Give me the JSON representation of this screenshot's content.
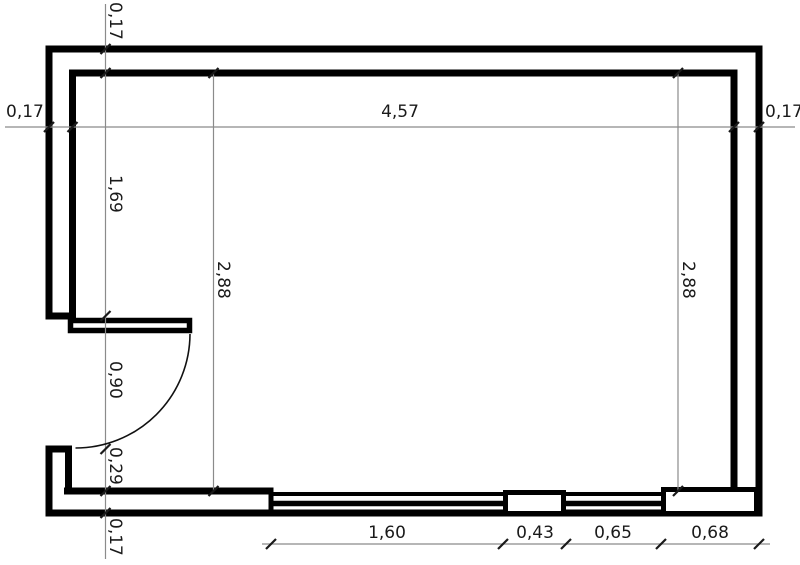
{
  "drawing": {
    "kind": "room floor plan with dimension annotations"
  },
  "dims": {
    "wall_top": "0,17",
    "wall_left": "0,17",
    "wall_right": "0,17",
    "wall_bottom": "0,17",
    "interior_width": "4,57",
    "interior_depth_left": "2,88",
    "interior_depth_right": "2,88",
    "left_segment": "1,69",
    "door_opening": "0,90",
    "door_to_wall": "0,29",
    "window1_width": "1,60",
    "pier_width": "0,43",
    "window2_width": "0,65",
    "corner_segment": "0,68"
  },
  "colors": {
    "wall": "#000000",
    "dimension_line": "#8b8b8b",
    "tick": "#1a1a1a",
    "text": "#1a1a1a",
    "background": "#ffffff"
  }
}
